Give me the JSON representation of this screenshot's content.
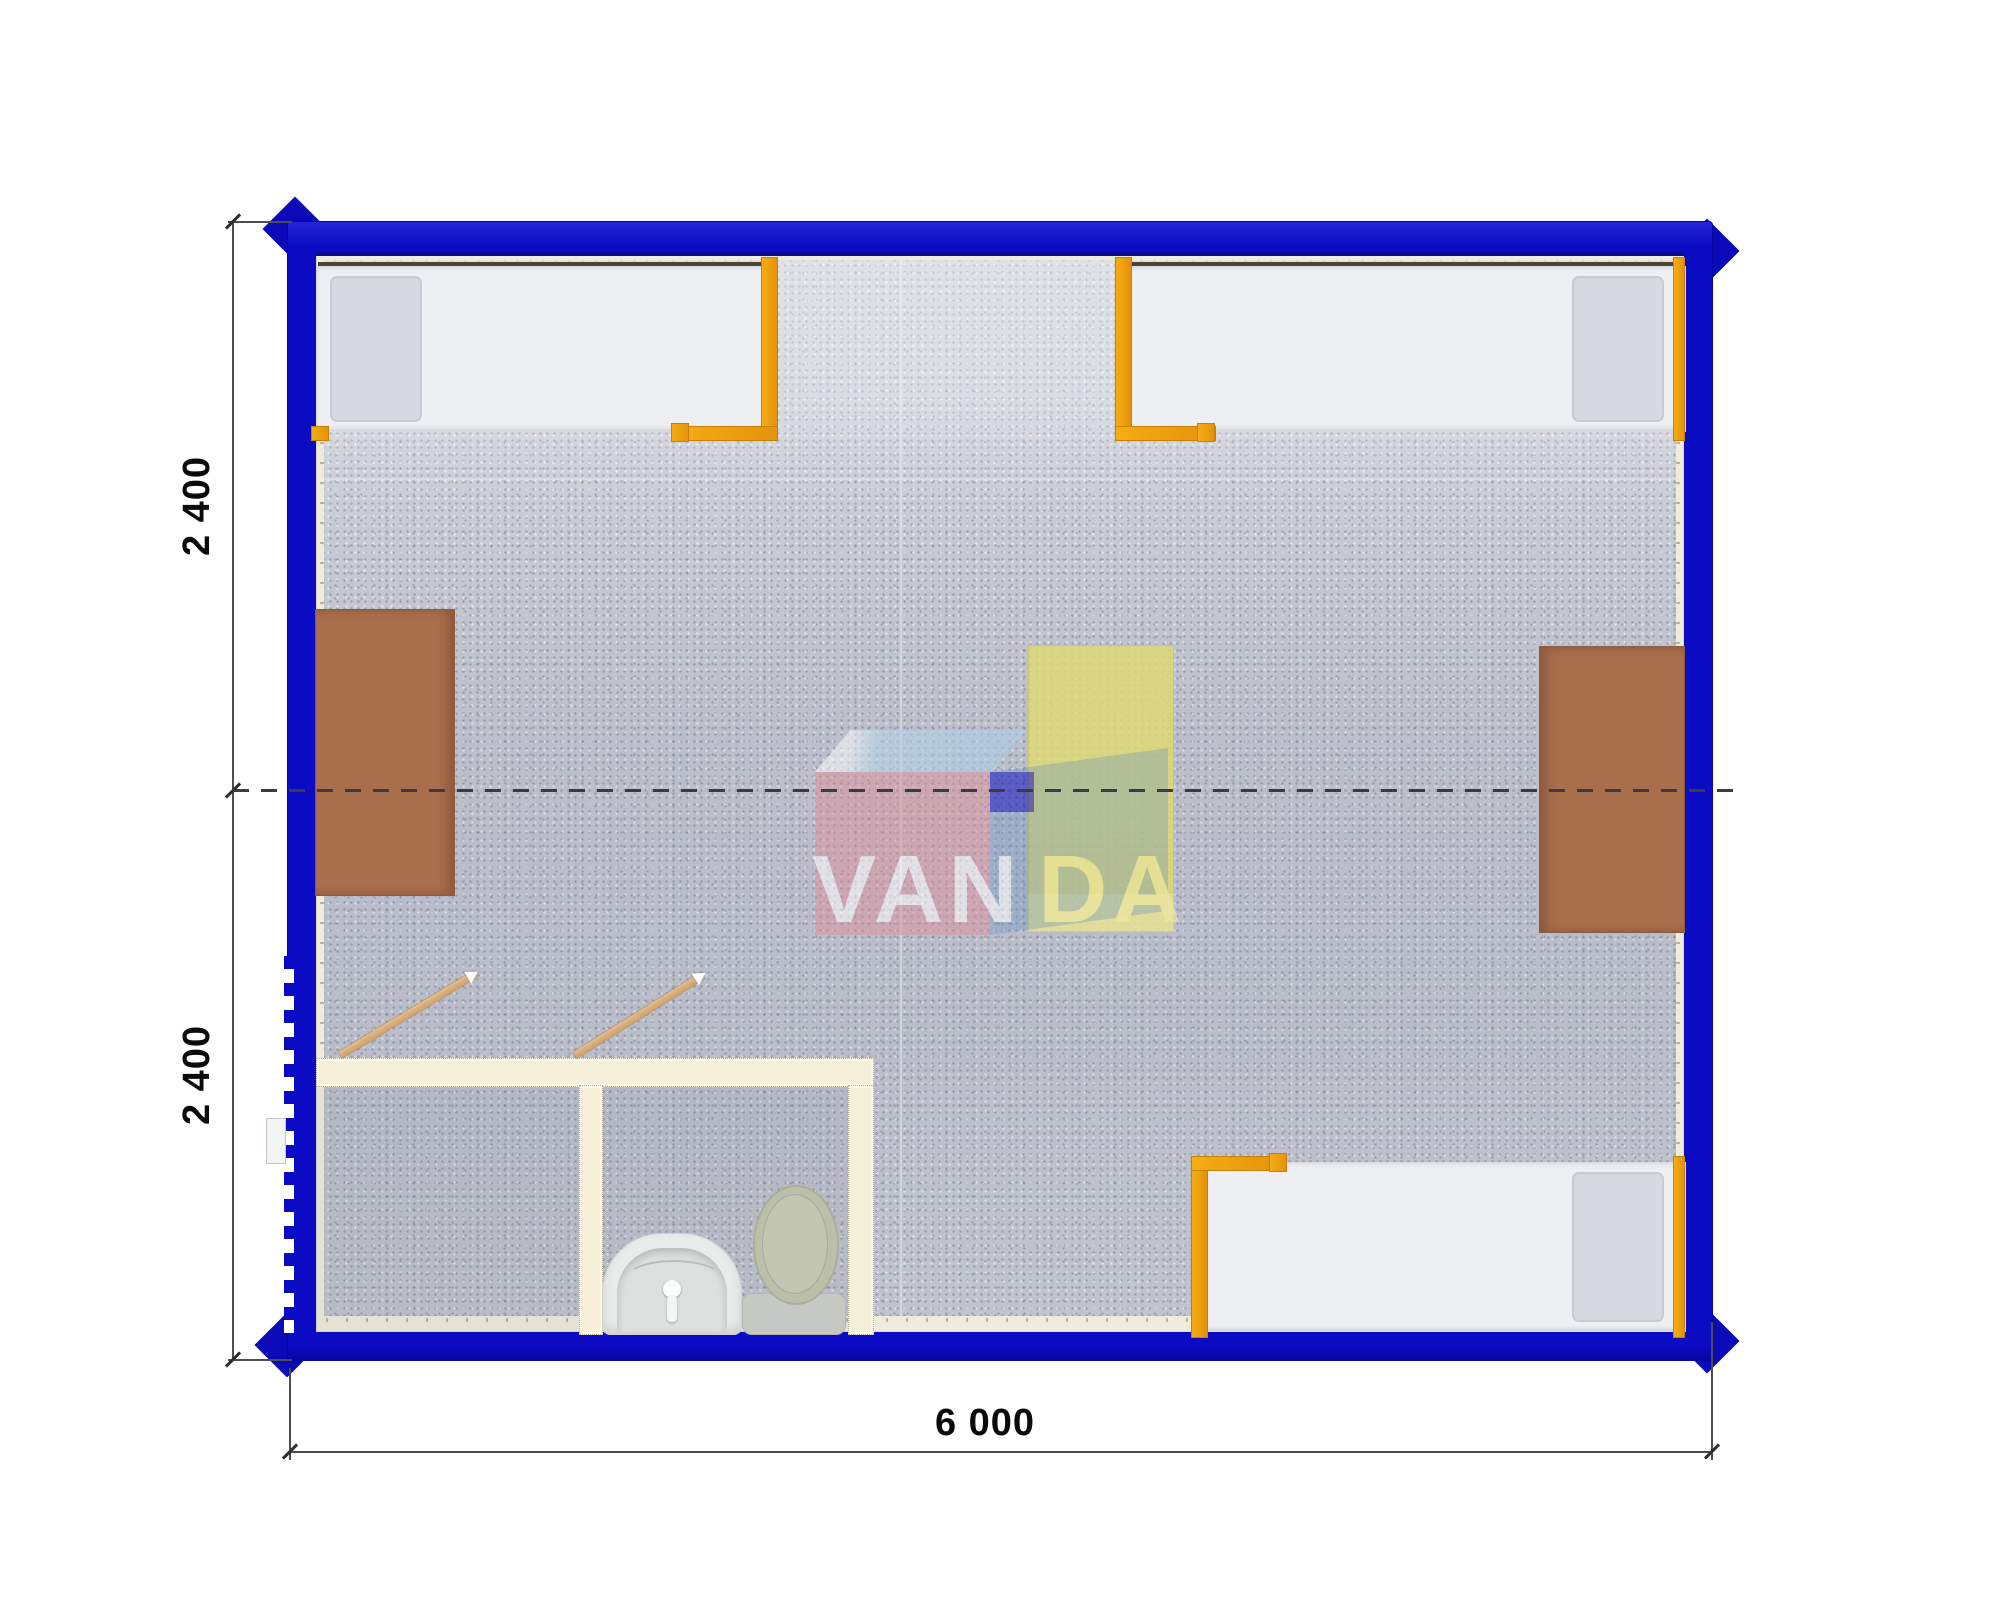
{
  "plan": {
    "kind": "container-house-floor-plan-top-view",
    "dimensions": {
      "side_top": "2 400",
      "side_bottom": "2 400",
      "bottom": "6 000"
    },
    "watermark": {
      "full": "VANDA",
      "left": "VAN",
      "right": "DA"
    },
    "colors": {
      "wall_blue": "#0b0bc4",
      "liner_cream": "#efecdc",
      "floor_gray": "#c6c9d3",
      "bed_frame_orange": "#f2a30b",
      "desk_brown": "#a96e4c",
      "center_table_yellow": "#ded878",
      "partition_cream": "#f5efd9",
      "logo_pink": "#e18a96",
      "logo_blue": "#5f8cbe",
      "logo_navy": "#1418bc"
    },
    "furniture": {
      "beds": "3",
      "desks": "2",
      "center_table": "1",
      "bathroom_fixtures": [
        "sink",
        "toilet"
      ],
      "door_swings": "2"
    }
  }
}
